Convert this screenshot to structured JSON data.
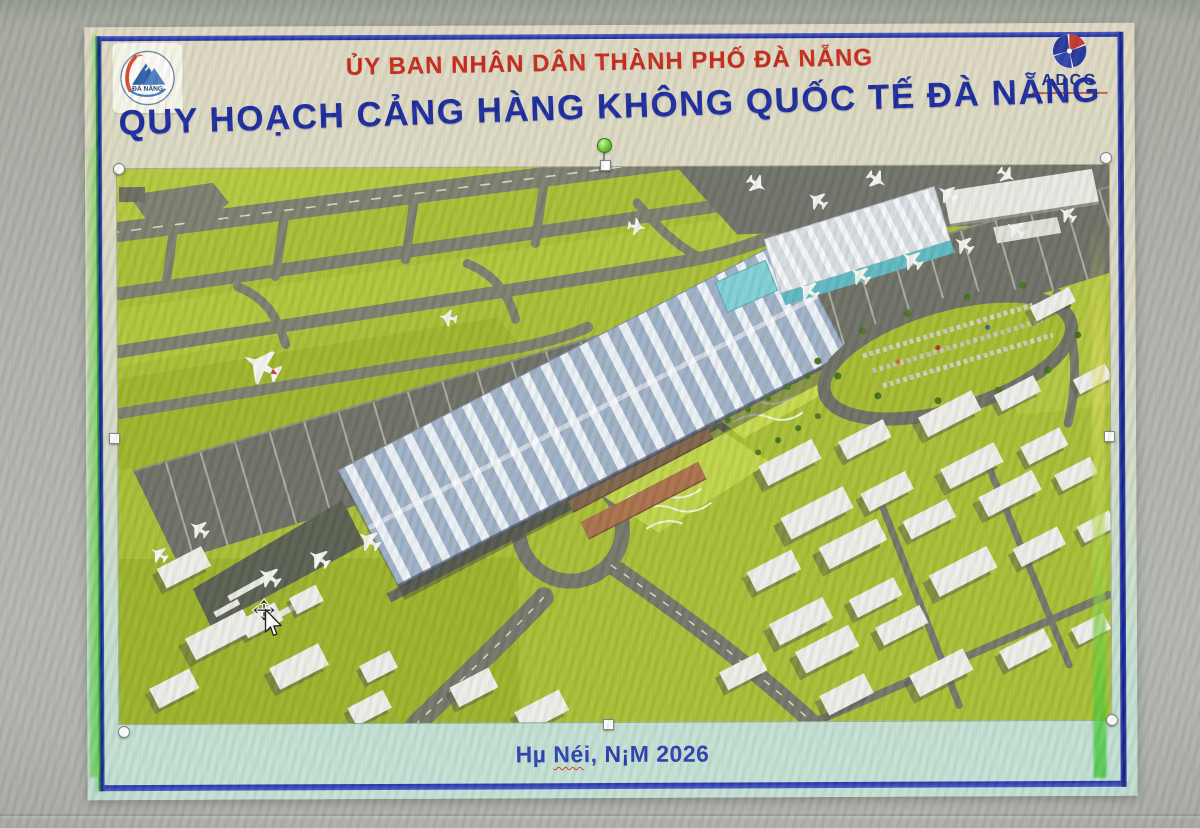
{
  "slide": {
    "org_title": "ỦY BAN NHÂN DÂN THÀNH PHỐ ĐÀ NẴNG",
    "main_title": "QUY HOẠCH CẢNG HÀNG KHÔNG QUỐC TẾ ĐÀ NẴNG",
    "footer": {
      "part1": "Hµ ",
      "part2": "Né",
      "part3": "i, N¡M 2026"
    },
    "logos": {
      "danang": {
        "caption": "ĐÀ NẴNG"
      },
      "adcc": {
        "wordmark": "ADCC"
      }
    },
    "colors": {
      "org_title_red": "#c62a1c",
      "main_title_blue": "#1b2b9e",
      "footer_blue": "#2b3fb0",
      "frame_blue": "#2030a6"
    }
  },
  "picture": {
    "description": "3D aerial rendering of Da Nang International Airport master plan",
    "selected": true
  },
  "cursor": {
    "type": "move"
  }
}
